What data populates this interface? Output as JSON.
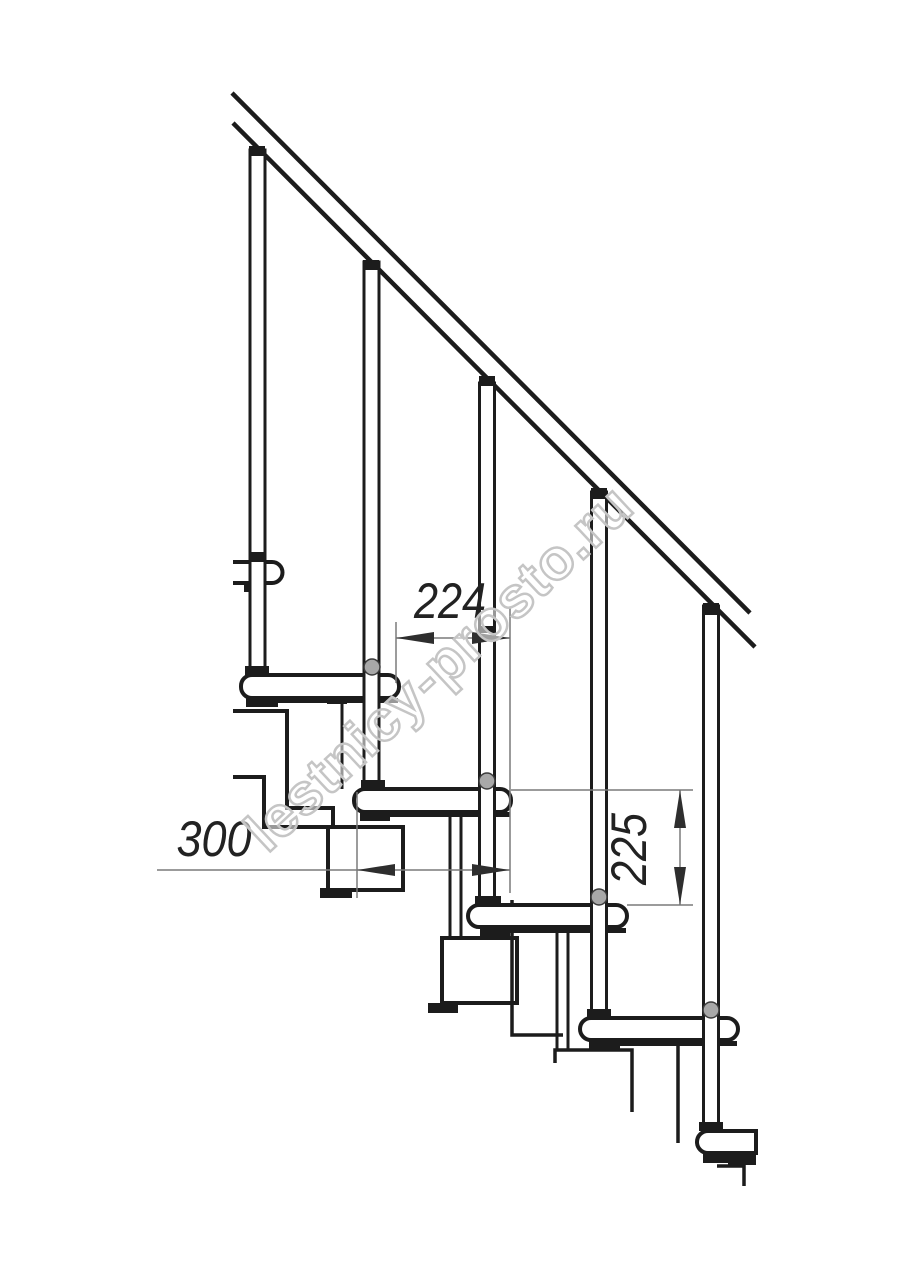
{
  "page": {
    "background": "#ffffff"
  },
  "drawing": {
    "type": "staircase-side-elevation-drawing",
    "dimensions": {
      "going": "224",
      "tread_width": "300",
      "rise": "225"
    },
    "watermark": "lestnicy-prosto.ru",
    "colors": {
      "line": "#1c1c1c",
      "dimension_line": "#7a7a7a",
      "arrow": "#2e2e2e",
      "dimension_text": "#222222",
      "watermark": "#c5c5c5",
      "background": "#ffffff"
    }
  }
}
